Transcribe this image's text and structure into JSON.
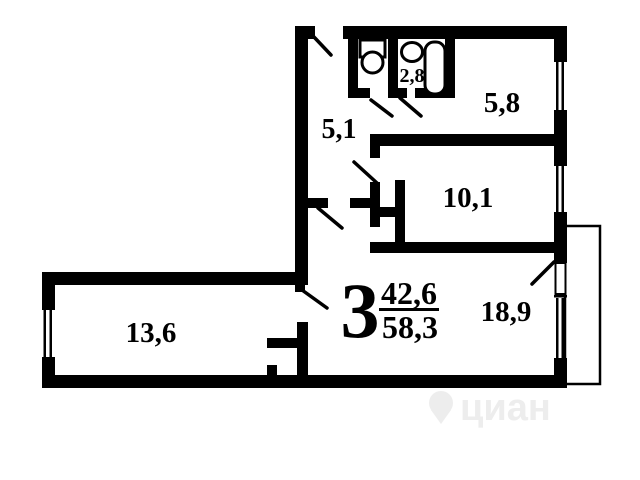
{
  "plan": {
    "type": "apartment-floor-plan",
    "summary": {
      "rooms_count": "3",
      "living_area": "42,6",
      "total_area": "58,3"
    },
    "rooms": {
      "corridor": {
        "area": "5,1"
      },
      "bathroom": {
        "area": "2,8"
      },
      "kitchen": {
        "area": "5,8"
      },
      "bedroom": {
        "area": "10,1"
      },
      "living_room": {
        "area": "18,9"
      },
      "bedroom_left": {
        "area": "13,6"
      }
    },
    "watermark": {
      "text": "циан"
    },
    "colors": {
      "wall": "#000000",
      "background": "#ffffff",
      "watermark": "#ededed"
    }
  }
}
